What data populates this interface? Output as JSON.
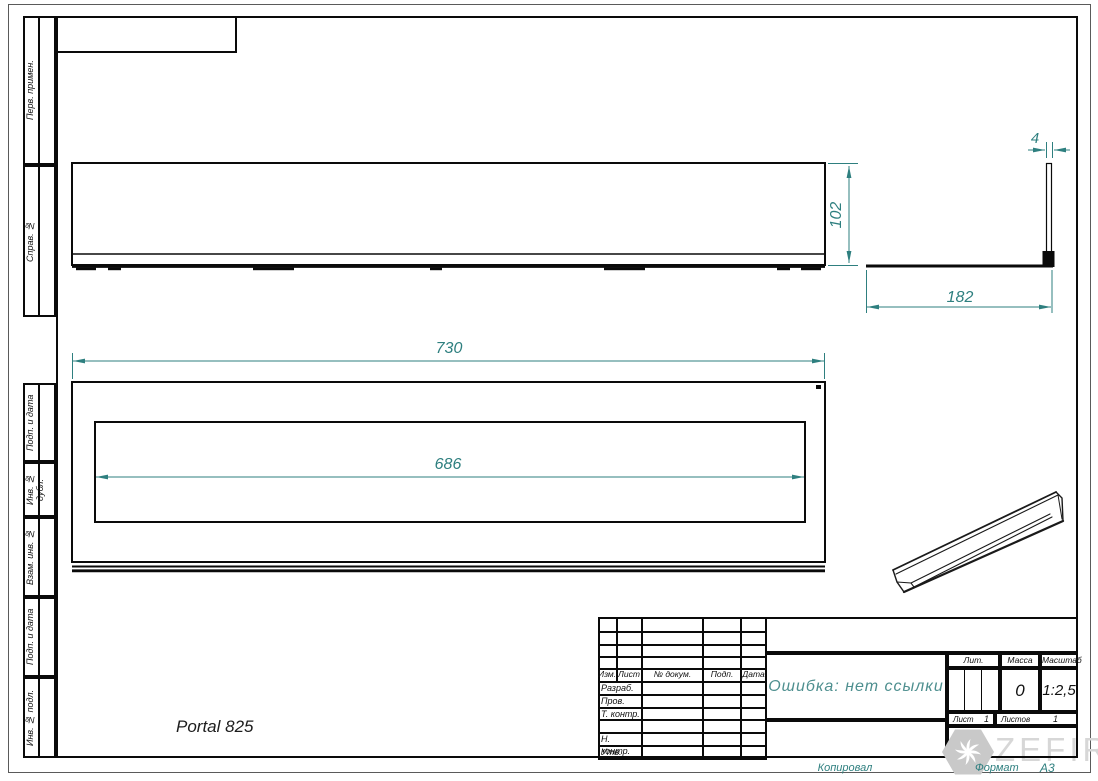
{
  "margins": {
    "top": [
      {
        "label": "Перв. примен."
      },
      {
        "label": "Справ. №"
      }
    ],
    "bottom": [
      {
        "label": "Подп. и дата"
      },
      {
        "label": "Инв. № дубл."
      },
      {
        "label": "Взам. инв. №"
      },
      {
        "label": "Подп. и дата"
      },
      {
        "label": "Инв. № подл."
      }
    ]
  },
  "drawing": {
    "part_note": "Portal 825",
    "dimensions": {
      "front_width": "730",
      "opening_width": "686",
      "height": "102",
      "side_depth": "182",
      "flange_thickness": "4"
    }
  },
  "title_block": {
    "revision_header": {
      "izm": "Изм.",
      "list": "Лист",
      "doc": "№ докум.",
      "sign": "Подп.",
      "date": "Дата"
    },
    "role_rows": [
      {
        "label": "Разраб."
      },
      {
        "label": "Пров."
      },
      {
        "label": "Т. контр."
      },
      {
        "label": ""
      },
      {
        "label": "Н. контр."
      },
      {
        "label": "Утв."
      }
    ],
    "doc_name": "Ошибка: нет ссылки",
    "lit_label": "Лит.",
    "mass_label": "Масса",
    "scale_label": "Масштаб",
    "mass_value": "0",
    "scale_value": "1:2,5",
    "sheet_label": "Лист",
    "sheet_value": "1",
    "sheets_label": "Листов",
    "sheets_value": "1"
  },
  "footer": {
    "copied": "Копировал",
    "format_label": "Формат",
    "format_value": "А3"
  },
  "watermark": {
    "brand": "ZEFIRE"
  },
  "colors": {
    "line_black": "#0A0A0A",
    "dimension_teal": "#2E7F7F",
    "doc_name_teal": "#4E8F8F",
    "watermark_gray": "#C9C9C9"
  }
}
